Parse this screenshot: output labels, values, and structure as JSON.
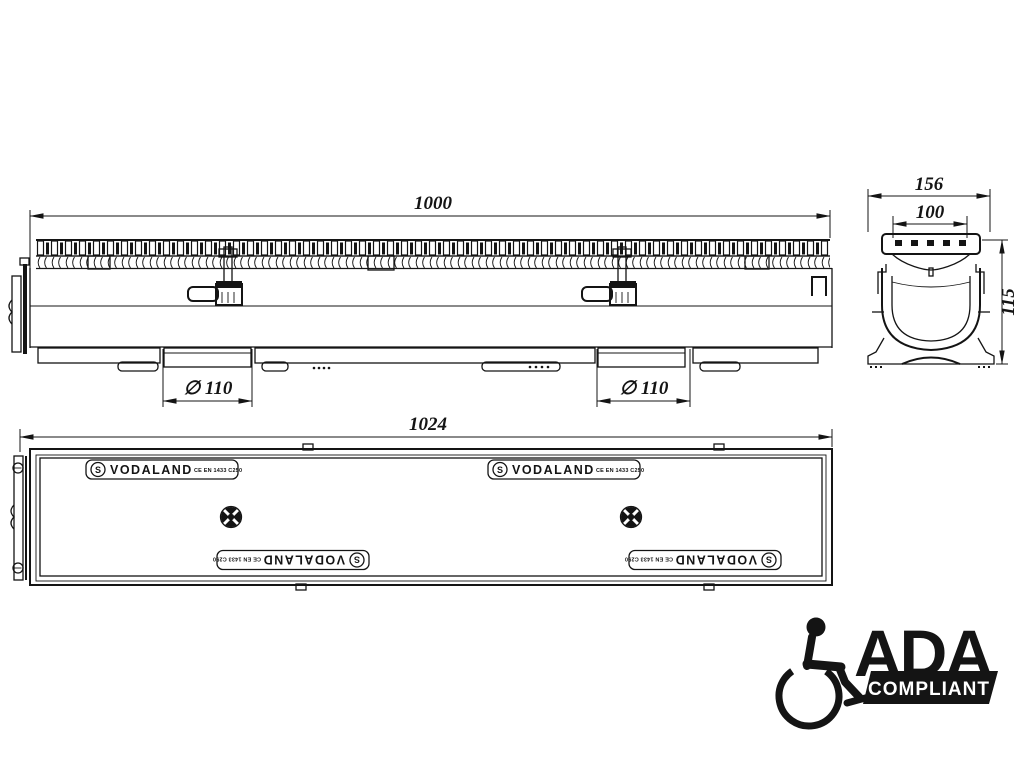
{
  "page": {
    "background": "#ffffff",
    "ink": "#141414"
  },
  "side_view": {
    "length_dim": "1000",
    "outlet_left_dim": "∅ 110",
    "outlet_right_dim": "∅ 110"
  },
  "section_view": {
    "width_dim": "156",
    "opening_dim": "100",
    "height_dim": "115"
  },
  "plan_view": {
    "length_dim": "1024",
    "brand": "VODALAND",
    "logo_letter": "S",
    "certification": "CE EN 1433 C250"
  },
  "ada_badge": {
    "title": "ADA",
    "subtitle": "COMPLIANT"
  }
}
